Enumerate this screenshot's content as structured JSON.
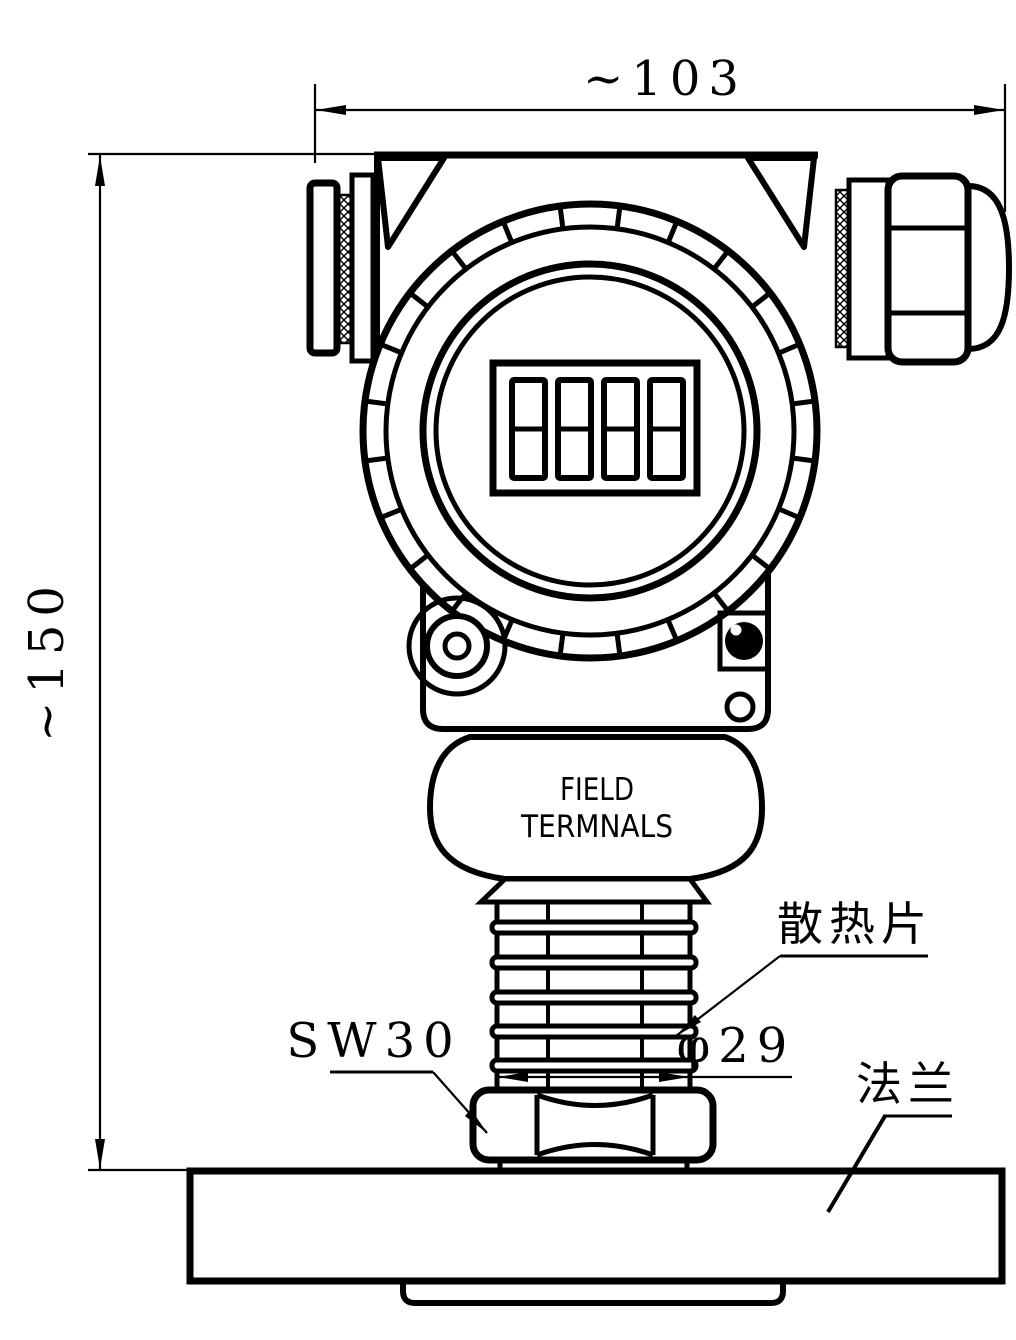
{
  "labels": {
    "width_dim": "~103",
    "height_dim": "~150",
    "field_line1": "FIELD",
    "field_line2": "TERMNALS",
    "heatsink": "散热片",
    "wrench_size": "SW30",
    "neck_diameter": "φ29",
    "flange": "法兰"
  },
  "display": {
    "digit_count": 4,
    "style": "blank seven-segment digits"
  },
  "colors": {
    "line": "#000000",
    "background": "#ffffff"
  }
}
